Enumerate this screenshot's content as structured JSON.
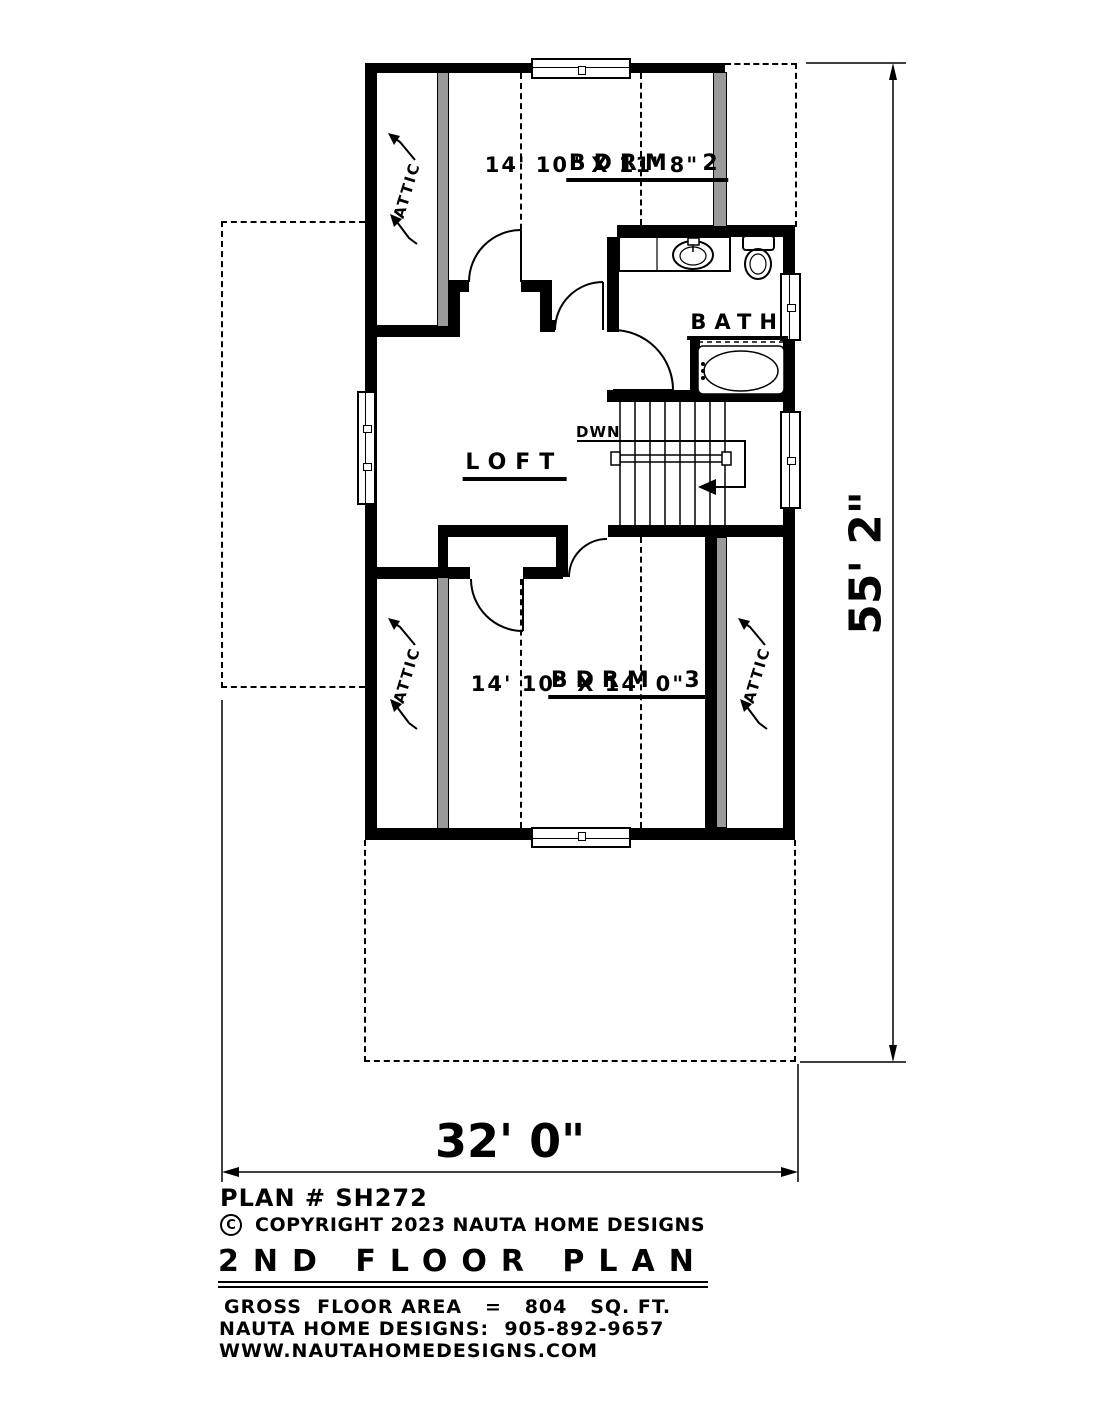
{
  "plan_number": "PLAN # SH272",
  "copyright": {
    "symbol": "C",
    "text": "COPYRIGHT 2023 NAUTA HOME DESIGNS"
  },
  "title": "2ND FLOOR PLAN",
  "footer": {
    "area_line": "GROSS  FLOOR AREA   =   804   SQ. FT.",
    "phone_line": "NAUTA HOME DESIGNS:  905-892-9657",
    "website": "WWW.NAUTAHOMEDESIGNS.COM"
  },
  "rooms": {
    "bdrm2": {
      "name": "BDRM 2",
      "dims": "14' 10\" X 11' 8\""
    },
    "bdrm3": {
      "name": "BDRM 3",
      "dims": "14' 10\" X 14' 0\""
    },
    "bath": {
      "name": "BATH"
    },
    "loft": {
      "name": "LOFT"
    },
    "stairs": {
      "label": "DWN"
    },
    "attic": {
      "label": "ATTIC"
    }
  },
  "dimensions": {
    "height": "55' 2\"",
    "width": "32' 0\""
  },
  "colors": {
    "wall": "#000000",
    "insulated_wall": "#9a9a9a",
    "background": "#ffffff"
  }
}
